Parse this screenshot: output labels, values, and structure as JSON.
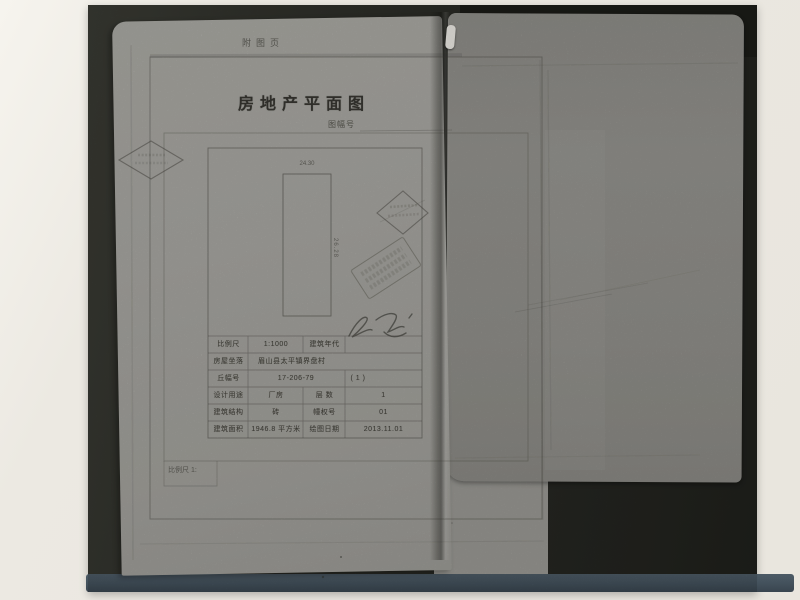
{
  "photo": {
    "colors": {
      "background": "#ece9e2",
      "backing": "#2a2b26",
      "sheet_left": "#a8a7a2",
      "sheet_right": "#94938e",
      "bottom_band": "#45535e"
    },
    "marks": {
      "diamond_stamp_left": "diamond-outline-stamp",
      "diamond_stamp_right": "diamond-outline-stamp",
      "seal_stamp": "rotated-rect-seal",
      "signature": "handwritten-scribble",
      "white_tab": "paper-slip"
    }
  },
  "document": {
    "page_label": "附图页",
    "title": "房地产平面图",
    "subtitle_label": "图幅号",
    "plan": {
      "width_dimension": "24.30",
      "height_dimension": "26.28"
    },
    "table": {
      "rows": [
        {
          "label": "比例尺",
          "value": "1:1000",
          "label2": "建筑年代",
          "value2": ""
        },
        {
          "label": "房屋坐落",
          "value": "眉山县太平镇界盘村"
        },
        {
          "label": "丘幅号",
          "value": "17-206-79",
          "value2": "( 1 )"
        },
        {
          "label": "设计用途",
          "value": "厂房",
          "label2": "层 数",
          "value2": "1"
        },
        {
          "label": "建筑结构",
          "value": "砖",
          "label2": "幢权号",
          "value2": "01"
        },
        {
          "label": "建筑面积",
          "value": "1946.8 平方米",
          "label2": "绘图日期",
          "value2": "2013.11.01"
        }
      ]
    },
    "footer_scale_label": "比例尺 1:"
  }
}
